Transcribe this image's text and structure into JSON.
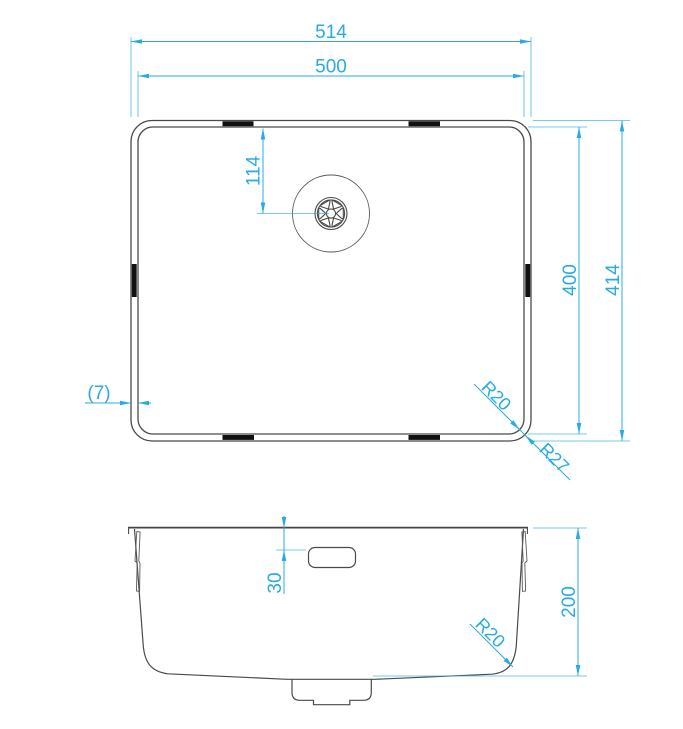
{
  "colors": {
    "dimension": "#29ABE2",
    "outline": "#4a4a4a",
    "clip": "#111111",
    "background": "#ffffff"
  },
  "top_view": {
    "dim_outer_width": "514",
    "dim_inner_width": "500",
    "dim_drain_offset": "114",
    "dim_inner_depth": "400",
    "dim_outer_depth": "414",
    "dim_rim_width": "(7)",
    "dim_inner_corner_radius": "R20",
    "dim_outer_corner_radius": "R27"
  },
  "front_view": {
    "dim_overflow_offset": "30",
    "dim_bowl_depth": "200",
    "dim_bottom_corner_radius": "R20"
  }
}
